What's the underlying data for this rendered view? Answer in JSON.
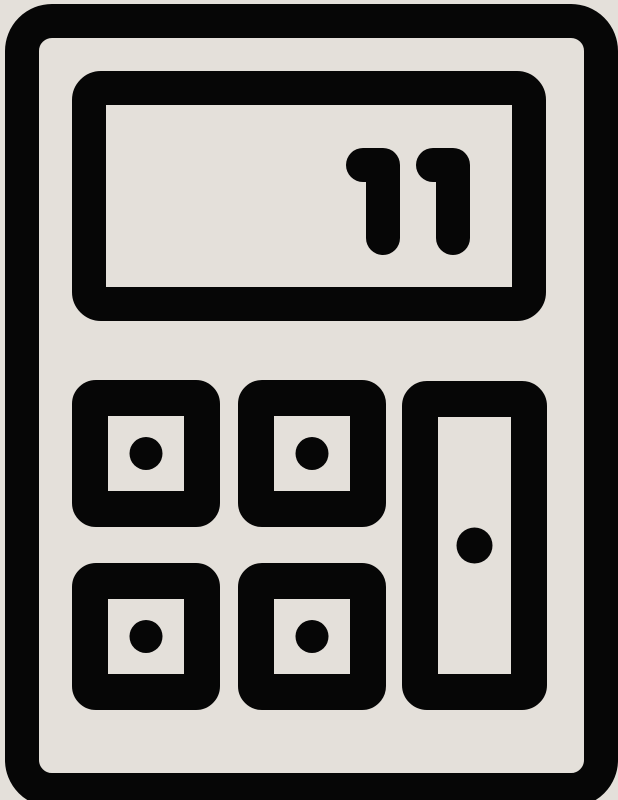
{
  "icon": {
    "name": "calculator-icon",
    "description": "calculator pictogram",
    "display_value": "11",
    "colors": {
      "ink": "#060606",
      "background": "#E4E0DA"
    },
    "keypad": {
      "small_button_count": 4,
      "tall_button_count": 1
    }
  }
}
